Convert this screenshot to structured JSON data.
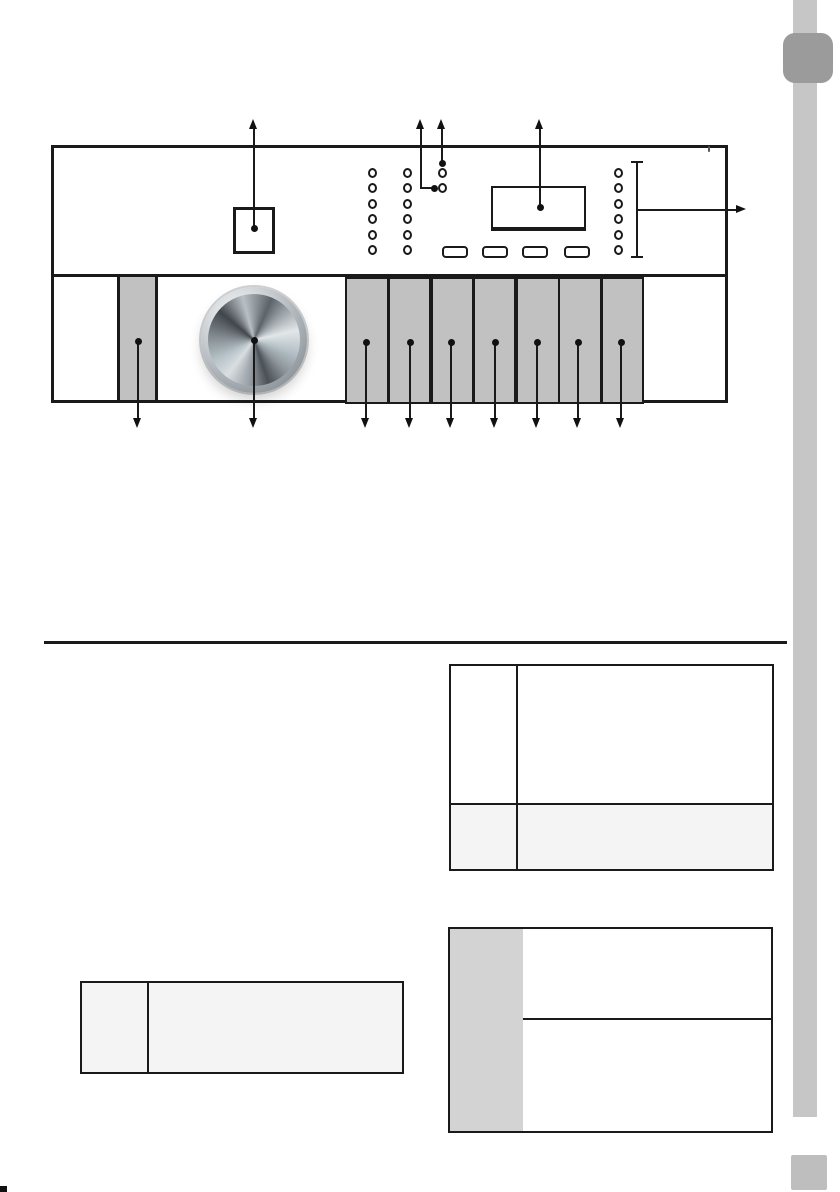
{
  "page": {
    "background": "#ffffff",
    "side_rail_color": "#c6c6c6",
    "corner_tab_color": "#9b9b9b",
    "page_marker_color": "#bebebe",
    "line_color": "#1a1a1a"
  },
  "diagram": {
    "description_icons": [
      "control-panel",
      "program-knob-icon",
      "detergent-dispenser-icon",
      "display-window",
      "status-led-icons",
      "panel-buttons"
    ],
    "line_color": "#1a1a1a",
    "button_fill": "#c1c1c1",
    "led_rows": {
      "start_y": 172.5,
      "gap": 15.5
    },
    "led_columns": [
      {
        "x": 372,
        "count": 6
      },
      {
        "x": 407,
        "count": 6
      },
      {
        "x": 442,
        "count": 2
      },
      {
        "x": 618,
        "count": 6
      }
    ],
    "pill_buttons": [
      {
        "cx": 453,
        "cy": 250
      },
      {
        "cx": 493,
        "cy": 250
      },
      {
        "cx": 533,
        "cy": 250
      },
      {
        "cx": 575,
        "cy": 250
      }
    ],
    "panel_buttons": [
      {
        "x": 345,
        "w": 40
      },
      {
        "x": 388,
        "w": 39
      },
      {
        "x": 431,
        "w": 39
      },
      {
        "x": 473,
        "w": 39
      },
      {
        "x": 516,
        "w": 40
      },
      {
        "x": 558,
        "w": 40
      },
      {
        "x": 601,
        "w": 39
      }
    ],
    "callout_dots": [
      {
        "x": 254,
        "y": 228
      },
      {
        "x": 434,
        "y": 188
      },
      {
        "x": 442,
        "y": 163
      },
      {
        "x": 540,
        "y": 207
      },
      {
        "x": 138,
        "y": 341
      },
      {
        "x": 254,
        "y": 340
      },
      {
        "x": 366,
        "y": 342
      },
      {
        "x": 410,
        "y": 342
      },
      {
        "x": 451,
        "y": 342
      },
      {
        "x": 495,
        "y": 342
      },
      {
        "x": 537,
        "y": 342
      },
      {
        "x": 578,
        "y": 342
      },
      {
        "x": 621,
        "y": 342
      }
    ],
    "arrows_up": [
      {
        "x": 254,
        "from_y": 228
      },
      {
        "x": 421,
        "from_y": 188,
        "elbow_to_x": 434
      },
      {
        "x": 442,
        "from_y": 163
      },
      {
        "x": 540,
        "from_y": 207
      }
    ],
    "arrow_tip_y_up": 119,
    "arrows_down": [
      {
        "x": 138,
        "from_y": 341
      },
      {
        "x": 254,
        "from_y": 340
      },
      {
        "x": 366,
        "from_y": 342
      },
      {
        "x": 410,
        "from_y": 342
      },
      {
        "x": 451,
        "from_y": 342
      },
      {
        "x": 495,
        "from_y": 342
      },
      {
        "x": 537,
        "from_y": 342
      },
      {
        "x": 578,
        "from_y": 342
      },
      {
        "x": 621,
        "from_y": 342
      }
    ],
    "arrow_tip_y_down": 428,
    "arrow_right": {
      "y": 210,
      "from_x": 637,
      "tip_x": 746
    },
    "bracket": {
      "x": 637,
      "y1": 162,
      "y2": 257
    }
  },
  "tables": {
    "right_top": {
      "cols": 2,
      "rows": 2,
      "row_fills": [
        "#ffffff",
        "#f4f4f4"
      ],
      "cells": [
        [
          "",
          ""
        ],
        [
          "",
          ""
        ]
      ]
    },
    "left_small": {
      "cols": 2,
      "rows": 1,
      "fill": "#f4f4f4",
      "cells": [
        [
          "",
          ""
        ]
      ]
    },
    "right_bottom": {
      "cols": 2,
      "rows": 2,
      "header_col_fill": "#d3d3d3",
      "body_fill": "#ffffff",
      "cells": [
        [
          "",
          ""
        ],
        [
          "",
          ""
        ]
      ]
    }
  }
}
